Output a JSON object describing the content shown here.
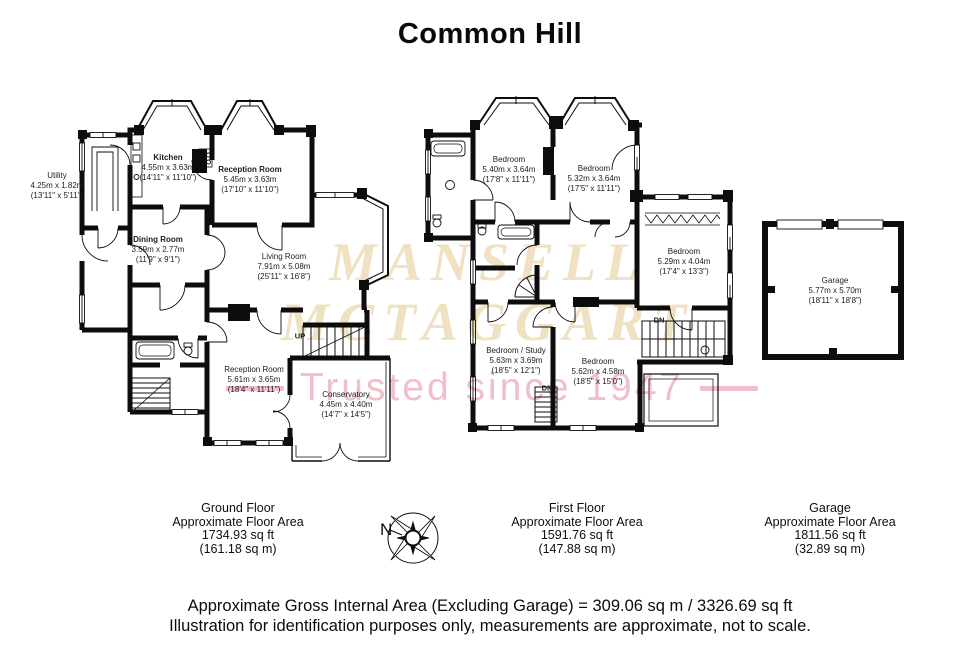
{
  "title": "Common Hill",
  "watermark": {
    "line1": "MANSELL",
    "line2": "MCTAGGART",
    "tagline": "Trusted since 1947",
    "serif_color": "#f0e1c2",
    "pink_color": "#f1bfca"
  },
  "compass": {
    "north_label": "N"
  },
  "ground_floor": {
    "stair_label": "UP",
    "rooms": [
      {
        "name": "Utility",
        "metric": "4.25m x 1.82m",
        "imperial": "(13'11\" x 5'11\")"
      },
      {
        "name": "Kitchen",
        "metric": "4.55m x 3.63m",
        "imperial": "(14'11\" x 11'10\")"
      },
      {
        "name": "Reception Room",
        "metric": "5.45m x 3.63m",
        "imperial": "(17'10\" x 11'10\")"
      },
      {
        "name": "Dining Room",
        "metric": "3.59m x 2.77m",
        "imperial": "(11'9\" x 9'1\")"
      },
      {
        "name": "Living Room",
        "metric": "7.91m x 5.08m",
        "imperial": "(25'11\" x 16'8\")"
      },
      {
        "name": "Reception Room",
        "metric": "5.61m x 3.65m",
        "imperial": "(18'4\" x 11'11\")"
      },
      {
        "name": "Conservatory",
        "metric": "4.45m x 4.40m",
        "imperial": "(14'7\" x 14'5\")"
      }
    ]
  },
  "first_floor": {
    "stair_label_right": "DN",
    "stair_label_bottom": "DN",
    "rooms": [
      {
        "name": "Bedroom",
        "metric": "5.40m x 3.64m",
        "imperial": "(17'8\" x 11'11\")"
      },
      {
        "name": "Bedroom",
        "metric": "5.32m x 3.64m",
        "imperial": "(17'5\" x 11'11\")"
      },
      {
        "name": "Bedroom",
        "metric": "5.29m x 4.04m",
        "imperial": "(17'4\" x 13'3\")"
      },
      {
        "name": "Bedroom / Study",
        "metric": "5.63m x 3.69m",
        "imperial": "(18'5\" x 12'1\")"
      },
      {
        "name": "Bedroom",
        "metric": "5.62m x 4.58m",
        "imperial": "(18'5\" x 15'0\")"
      }
    ]
  },
  "garage": {
    "room": {
      "name": "Garage",
      "metric": "5.77m x 5.70m",
      "imperial": "(18'11\" x 18'8\")"
    }
  },
  "summaries": {
    "ground": {
      "title": "Ground Floor",
      "subtitle": "Approximate Floor Area",
      "sqft": "1734.93 sq ft",
      "sqm": "(161.18 sq m)"
    },
    "first": {
      "title": "First Floor",
      "subtitle": "Approximate Floor Area",
      "sqft": "1591.76 sq ft",
      "sqm": "(147.88 sq m)"
    },
    "garage": {
      "title": "Garage",
      "subtitle": "Approximate Floor Area",
      "sqft": "1811.56 sq ft",
      "sqm": "(32.89 sq m)"
    }
  },
  "footer": {
    "line1": "Approximate Gross Internal Area (Excluding Garage) = 309.06 sq m / 3326.69 sq ft",
    "line2": "Illustration for identification purposes only, measurements are approximate, not to scale."
  }
}
